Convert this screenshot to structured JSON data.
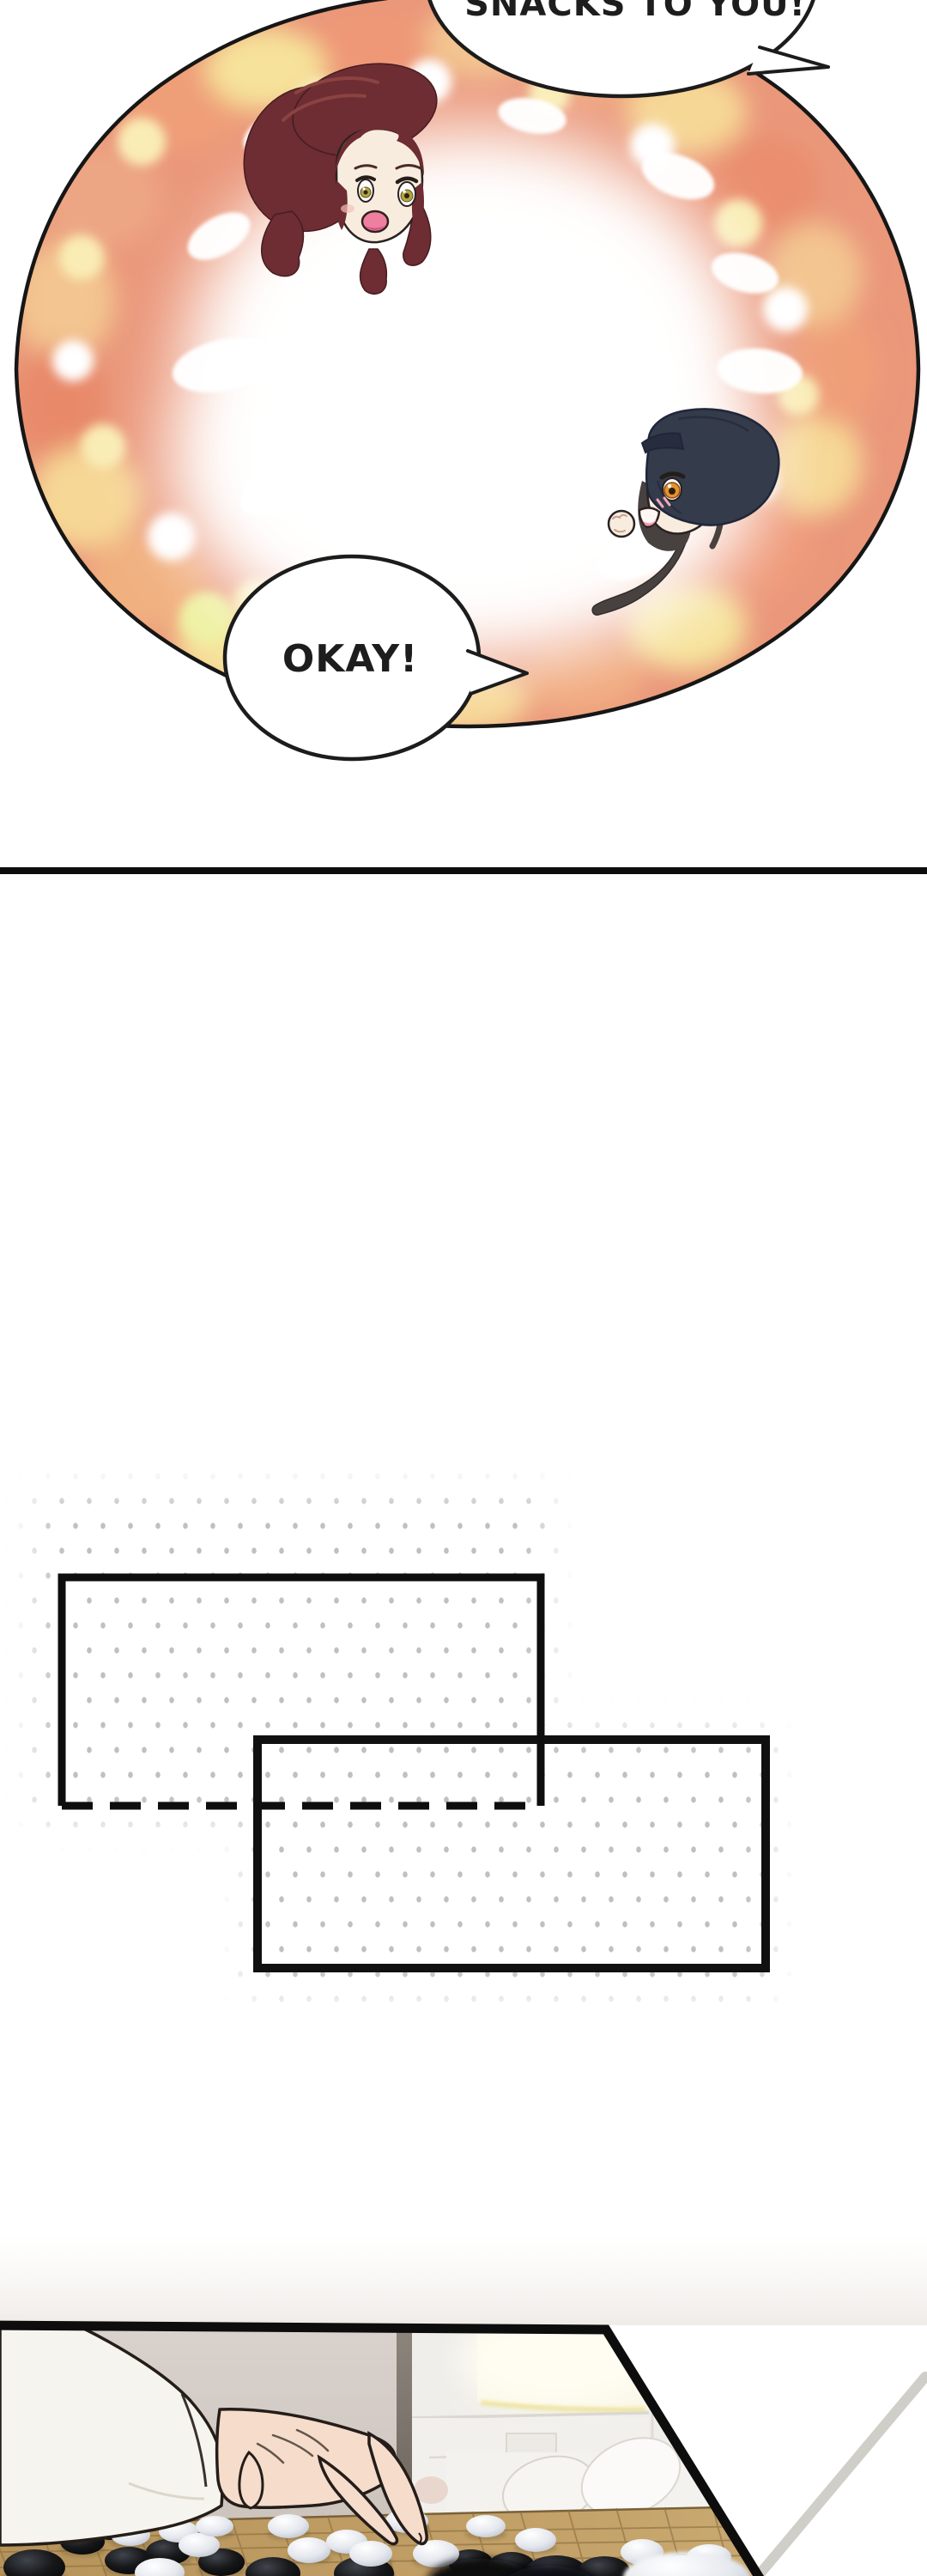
{
  "comic": {
    "flashback": {
      "bubble_top_text": "SNACKS TO YOU!",
      "bubble_okay_text": "OKAY!"
    },
    "palette": {
      "panel_outline": "#161616",
      "bokeh_coral": "#ea977a",
      "bokeh_light_orange": "#f0b286",
      "bokeh_gold": "#f6d795",
      "bokeh_pale_yellow": "#f9ecb4",
      "divider": "#0c0c0c",
      "sketch_dot": "#c2bfbd",
      "sketch_border": "#101010",
      "wall": "#d6cfc9",
      "board": "#c2a067",
      "board_line": "#8d7040",
      "stone_black": "#17181a",
      "stone_white": "#e7eaf0",
      "skin": "#f5dccb",
      "sleeve": "#f6f4ee"
    }
  }
}
